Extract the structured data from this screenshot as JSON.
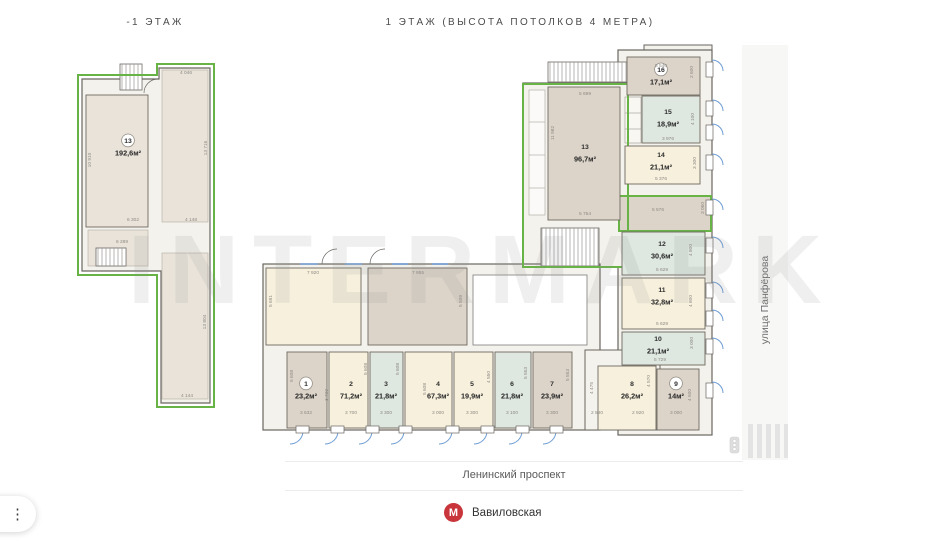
{
  "titles": {
    "left_floor": "-1 ЭТАЖ",
    "right_floor": "1 ЭТАЖ (ВЫСОТА ПОТОЛКОВ 4 МЕТРА)"
  },
  "watermark": "INTERMARK",
  "streets": {
    "bottom": "Ленинский проспект",
    "right": "улица Панфёрова"
  },
  "metro": {
    "station": "Вавиловская",
    "logo_letter": "М"
  },
  "menu": {
    "kebab_icon": "⋮"
  },
  "colors": {
    "accent_green": "#67b346",
    "metro_red": "#c8353a",
    "window_blue": "#6d9bd3",
    "wall_gray": "#5f5c57",
    "dim_text": "#8e8a84",
    "fills": {
      "taupe": "#dcd4c9",
      "cream": "#f6f0dd",
      "mint": "#dee7e0",
      "plan_beige": "#e9e3da",
      "base": "#f4f2ec"
    }
  },
  "rooms": [
    {
      "plan": "-1",
      "num": "13",
      "area": "192,6м²",
      "circled": true,
      "x": 86,
      "y": 95,
      "w": 62,
      "h": 132,
      "fill": "plan_beige",
      "lx": 128,
      "ly": 143
    },
    {
      "plan": "1",
      "num": "13",
      "area": "96,7м²",
      "circled": false,
      "x": 548,
      "y": 87,
      "w": 72,
      "h": 133,
      "fill": "taupe",
      "lx": 585,
      "ly": 149
    },
    {
      "plan": "1",
      "num": "16",
      "area": "17,1м²",
      "circled": true,
      "x": 627,
      "y": 57,
      "w": 73,
      "h": 38,
      "fill": "taupe",
      "lx": 661,
      "ly": 72
    },
    {
      "plan": "1",
      "num": "15",
      "area": "18,9м²",
      "circled": false,
      "x": 642,
      "y": 96,
      "w": 58,
      "h": 47,
      "fill": "mint",
      "lx": 668,
      "ly": 114
    },
    {
      "plan": "1",
      "num": "14",
      "area": "21,1м²",
      "circled": false,
      "x": 625,
      "y": 146,
      "w": 75,
      "h": 38,
      "fill": "cream",
      "lx": 661,
      "ly": 157
    },
    {
      "plan": "1",
      "num": "12",
      "area": "30,6м²",
      "circled": false,
      "x": 622,
      "y": 232,
      "w": 83,
      "h": 43,
      "fill": "mint",
      "lx": 662,
      "ly": 246
    },
    {
      "plan": "1",
      "num": "11",
      "area": "32,8м²",
      "circled": false,
      "x": 622,
      "y": 278,
      "w": 83,
      "h": 51,
      "fill": "cream",
      "lx": 662,
      "ly": 292
    },
    {
      "plan": "1",
      "num": "10",
      "area": "21,1м²",
      "circled": false,
      "x": 622,
      "y": 332,
      "w": 83,
      "h": 33,
      "fill": "mint",
      "lx": 658,
      "ly": 341
    },
    {
      "plan": "1",
      "num": "9",
      "area": "14м²",
      "circled": true,
      "x": 657,
      "y": 369,
      "w": 42,
      "h": 61,
      "fill": "taupe",
      "lx": 676,
      "ly": 386
    },
    {
      "plan": "1",
      "num": "8",
      "area": "26,2м²",
      "circled": false,
      "x": 598,
      "y": 366,
      "w": 58,
      "h": 64,
      "fill": "cream",
      "lx": 632,
      "ly": 386
    },
    {
      "plan": "1",
      "num": "1",
      "area": "23,2м²",
      "circled": true,
      "x": 287,
      "y": 352,
      "w": 40,
      "h": 76,
      "fill": "taupe",
      "lx": 306,
      "ly": 386
    },
    {
      "plan": "1",
      "num": "2",
      "area": "71,2м²",
      "circled": false,
      "x": 329,
      "y": 352,
      "w": 39,
      "h": 76,
      "fill": "cream",
      "lx": 351,
      "ly": 386
    },
    {
      "plan": "1",
      "num": "3",
      "area": "21,8м²",
      "circled": false,
      "x": 370,
      "y": 352,
      "w": 33,
      "h": 76,
      "fill": "mint",
      "lx": 386,
      "ly": 386
    },
    {
      "plan": "1",
      "num": "4",
      "area": "67,3м²",
      "circled": false,
      "x": 405,
      "y": 352,
      "w": 47,
      "h": 76,
      "fill": "cream",
      "lx": 438,
      "ly": 386
    },
    {
      "plan": "1",
      "num": "5",
      "area": "19,9м²",
      "circled": false,
      "x": 454,
      "y": 352,
      "w": 39,
      "h": 76,
      "fill": "cream",
      "lx": 472,
      "ly": 386
    },
    {
      "plan": "1",
      "num": "6",
      "area": "21,8м²",
      "circled": false,
      "x": 495,
      "y": 352,
      "w": 36,
      "h": 76,
      "fill": "mint",
      "lx": 512,
      "ly": 386
    },
    {
      "plan": "1",
      "num": "7",
      "area": "23,9м²",
      "circled": false,
      "x": 533,
      "y": 352,
      "w": 39,
      "h": 76,
      "fill": "taupe",
      "lx": 552,
      "ly": 386
    }
  ],
  "dims": [
    {
      "t": "4 046",
      "x": 186,
      "y": 74
    },
    {
      "t": "13 716",
      "x": 207,
      "y": 148,
      "r": 90
    },
    {
      "t": "10 910",
      "x": 91,
      "y": 160,
      "r": 90
    },
    {
      "t": "6 302",
      "x": 133,
      "y": 221
    },
    {
      "t": "4 148",
      "x": 191,
      "y": 221
    },
    {
      "t": "6 289",
      "x": 122,
      "y": 243
    },
    {
      "t": "13 804",
      "x": 206,
      "y": 322,
      "r": 90
    },
    {
      "t": "4 144",
      "x": 187,
      "y": 397
    },
    {
      "t": "5 699",
      "x": 585,
      "y": 95
    },
    {
      "t": "11 982",
      "x": 554,
      "y": 133,
      "r": 90
    },
    {
      "t": "5 754",
      "x": 585,
      "y": 215
    },
    {
      "t": "5 540",
      "x": 661,
      "y": 67
    },
    {
      "t": "2 600",
      "x": 693,
      "y": 72,
      "r": 90
    },
    {
      "t": "4 100",
      "x": 694,
      "y": 119,
      "r": 90
    },
    {
      "t": "3 976",
      "x": 668,
      "y": 140
    },
    {
      "t": "3 300",
      "x": 696,
      "y": 163,
      "r": 90
    },
    {
      "t": "5 376",
      "x": 661,
      "y": 180
    },
    {
      "t": "5 576",
      "x": 658,
      "y": 211
    },
    {
      "t": "3 060",
      "x": 704,
      "y": 208,
      "r": 90
    },
    {
      "t": "4 800",
      "x": 692,
      "y": 250,
      "r": 90
    },
    {
      "t": "5 629",
      "x": 662,
      "y": 271
    },
    {
      "t": "4 800",
      "x": 692,
      "y": 301,
      "r": 90
    },
    {
      "t": "5 629",
      "x": 662,
      "y": 325
    },
    {
      "t": "3 000",
      "x": 693,
      "y": 343,
      "r": 90
    },
    {
      "t": "5 729",
      "x": 660,
      "y": 361
    },
    {
      "t": "4 500",
      "x": 691,
      "y": 395,
      "r": 90
    },
    {
      "t": "3 000",
      "x": 676,
      "y": 414
    },
    {
      "t": "4 570",
      "x": 650,
      "y": 381,
      "r": 90
    },
    {
      "t": "2 920",
      "x": 638,
      "y": 414
    },
    {
      "t": "4 475",
      "x": 593,
      "y": 388,
      "r": 90
    },
    {
      "t": "2 580",
      "x": 597,
      "y": 414
    },
    {
      "t": "7 920",
      "x": 313,
      "y": 274
    },
    {
      "t": "5 691",
      "x": 272,
      "y": 301,
      "r": 90
    },
    {
      "t": "7 955",
      "x": 418,
      "y": 274
    },
    {
      "t": "5 509",
      "x": 462,
      "y": 301,
      "r": 90
    },
    {
      "t": "5 608",
      "x": 293,
      "y": 376,
      "r": 90
    },
    {
      "t": "3 632",
      "x": 306,
      "y": 414
    },
    {
      "t": "3 700",
      "x": 328,
      "y": 395,
      "r": 90
    },
    {
      "t": "3 700",
      "x": 351,
      "y": 414
    },
    {
      "t": "5 608",
      "x": 367,
      "y": 369,
      "r": 90
    },
    {
      "t": "3 300",
      "x": 386,
      "y": 414
    },
    {
      "t": "5 608",
      "x": 399,
      "y": 369,
      "r": 90
    },
    {
      "t": "3 000",
      "x": 438,
      "y": 414
    },
    {
      "t": "5 608",
      "x": 426,
      "y": 389,
      "r": 90
    },
    {
      "t": "3 300",
      "x": 472,
      "y": 414
    },
    {
      "t": "4 550",
      "x": 490,
      "y": 377,
      "r": 90
    },
    {
      "t": "3 100",
      "x": 512,
      "y": 414
    },
    {
      "t": "5 553",
      "x": 527,
      "y": 373,
      "r": 90
    },
    {
      "t": "3 300",
      "x": 552,
      "y": 414
    },
    {
      "t": "5 553",
      "x": 569,
      "y": 375,
      "r": 90
    }
  ]
}
